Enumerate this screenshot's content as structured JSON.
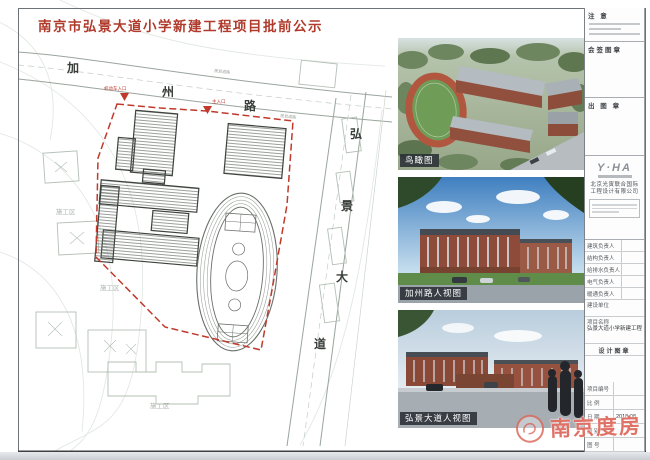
{
  "page": {
    "title": "南京市弘景大道小学新建工程项目批前公示"
  },
  "site_plan": {
    "road_top": {
      "chars": [
        "加",
        "州",
        "路"
      ]
    },
    "road_right": {
      "chars": [
        "弘",
        "景",
        "大",
        "道"
      ]
    },
    "road_note": "规划道路",
    "entrance_1": "机动车入口",
    "entrance_2": "主入口",
    "zone_label": "施工区"
  },
  "renderings": [
    {
      "label": "鸟瞰图"
    },
    {
      "label": "加州路人视图"
    },
    {
      "label": "弘景大道人视图"
    }
  ],
  "title_block": {
    "notes_header": "注 意",
    "sign_stamp_header": "会签图章",
    "out_stamp_header": "出 图 章",
    "design_stamp_header": "设计图章",
    "logo_text": "Y·HA",
    "company_line1": "北京光寅联合国际",
    "company_line2": "工程设计有限公司",
    "person_rows": [
      "建筑负责人",
      "结构负责人",
      "给排水负责人",
      "电气负责人",
      "暖通负责人"
    ],
    "info_rows": [
      {
        "label": "建设单位",
        "value": ""
      },
      {
        "label": "项目名称",
        "value": "弘景大道小学新建工程"
      }
    ],
    "meta_rows": [
      {
        "label": "项目编号",
        "value": ""
      },
      {
        "label": "比  例",
        "value": ""
      },
      {
        "label": "日  期",
        "value": "2018.08"
      },
      {
        "label": "图  别",
        "value": ""
      },
      {
        "label": "图  号",
        "value": ""
      }
    ]
  },
  "watermark": {
    "text": "南京度房"
  },
  "colors": {
    "title_red": "#b03a2b",
    "boundary_red": "#c0392b",
    "watermark_red": "#d95246"
  }
}
